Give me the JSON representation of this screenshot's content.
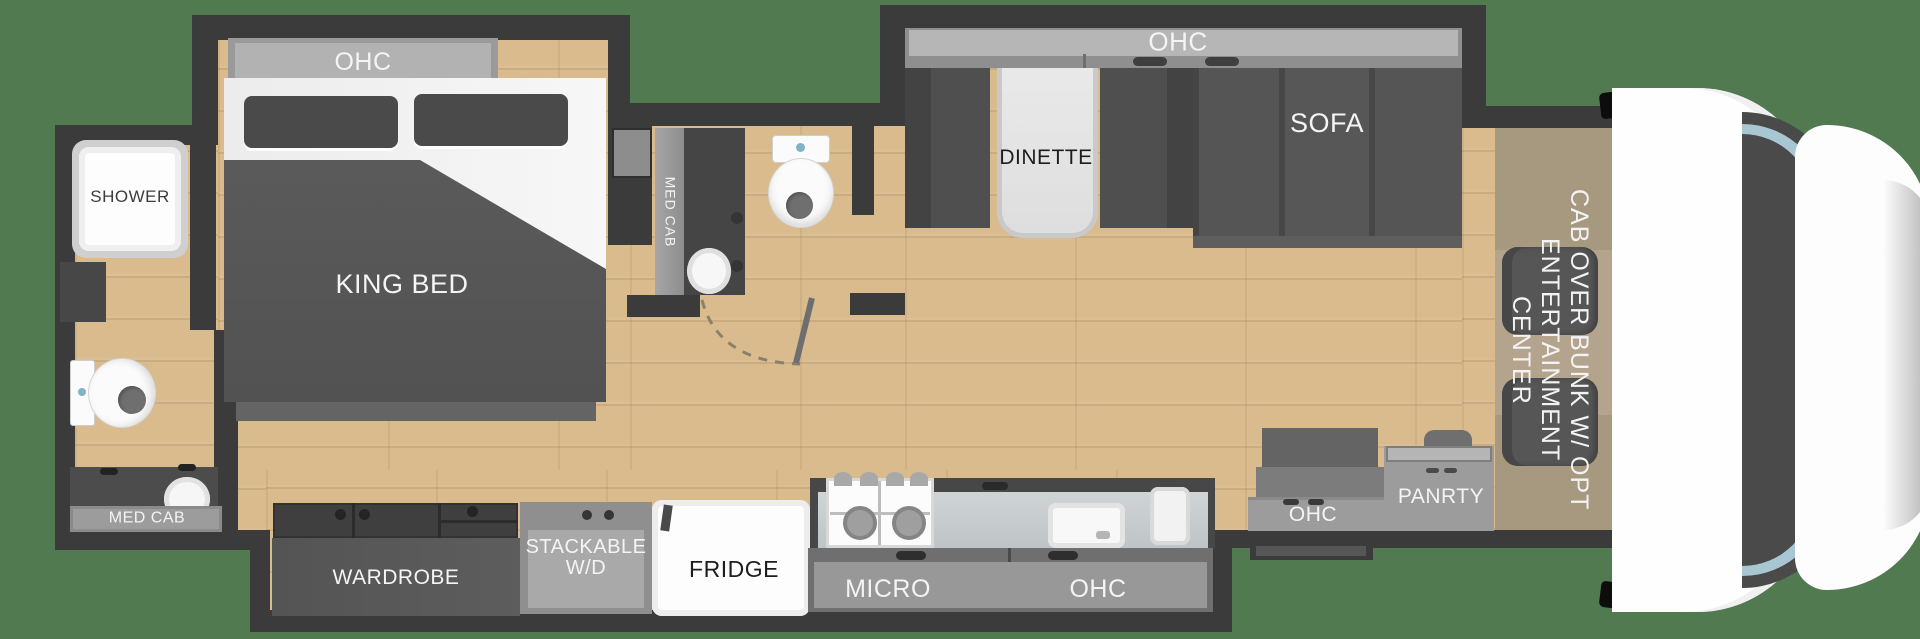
{
  "title": "RV floor plan - class C motorhome with king bed",
  "colors": {
    "background_green": "#527a50",
    "wall_dark": "#3b3b3b",
    "floor_wood": "#d9bb8e",
    "cab_carpet": "#b4a48e",
    "furniture_dark_gray": "#4f4f4f",
    "cabinet_gray": "#9a9a9a",
    "fixture_white": "#ffffff",
    "windshield_blue": "#a9c7d2"
  },
  "bedroom": {
    "ohc_label": "OHC",
    "bed_label": "KING BED"
  },
  "rear_bath": {
    "shower_label": "SHOWER",
    "med_cab_label": "MED CAB"
  },
  "mid_bath": {
    "med_cab_label": "MED CAB"
  },
  "living": {
    "ohc_label": "OHC",
    "dinette_label": "DINETTE",
    "sofa_label": "SOFA"
  },
  "kitchen": {
    "wardrobe_label": "WARDROBE",
    "washer_dryer_line1": "STACKABLE",
    "washer_dryer_line2": "W/D",
    "fridge_label": "FRIDGE",
    "micro_label": "MICRO",
    "ohc_label": "OHC"
  },
  "entry": {
    "ohc_label": "OHC",
    "pantry_label": "PANRTY"
  },
  "cab": {
    "label_line1": "CAB OVER BUNK W/ OPT",
    "label_line2": "ENTERTAINMENT CENTER"
  }
}
